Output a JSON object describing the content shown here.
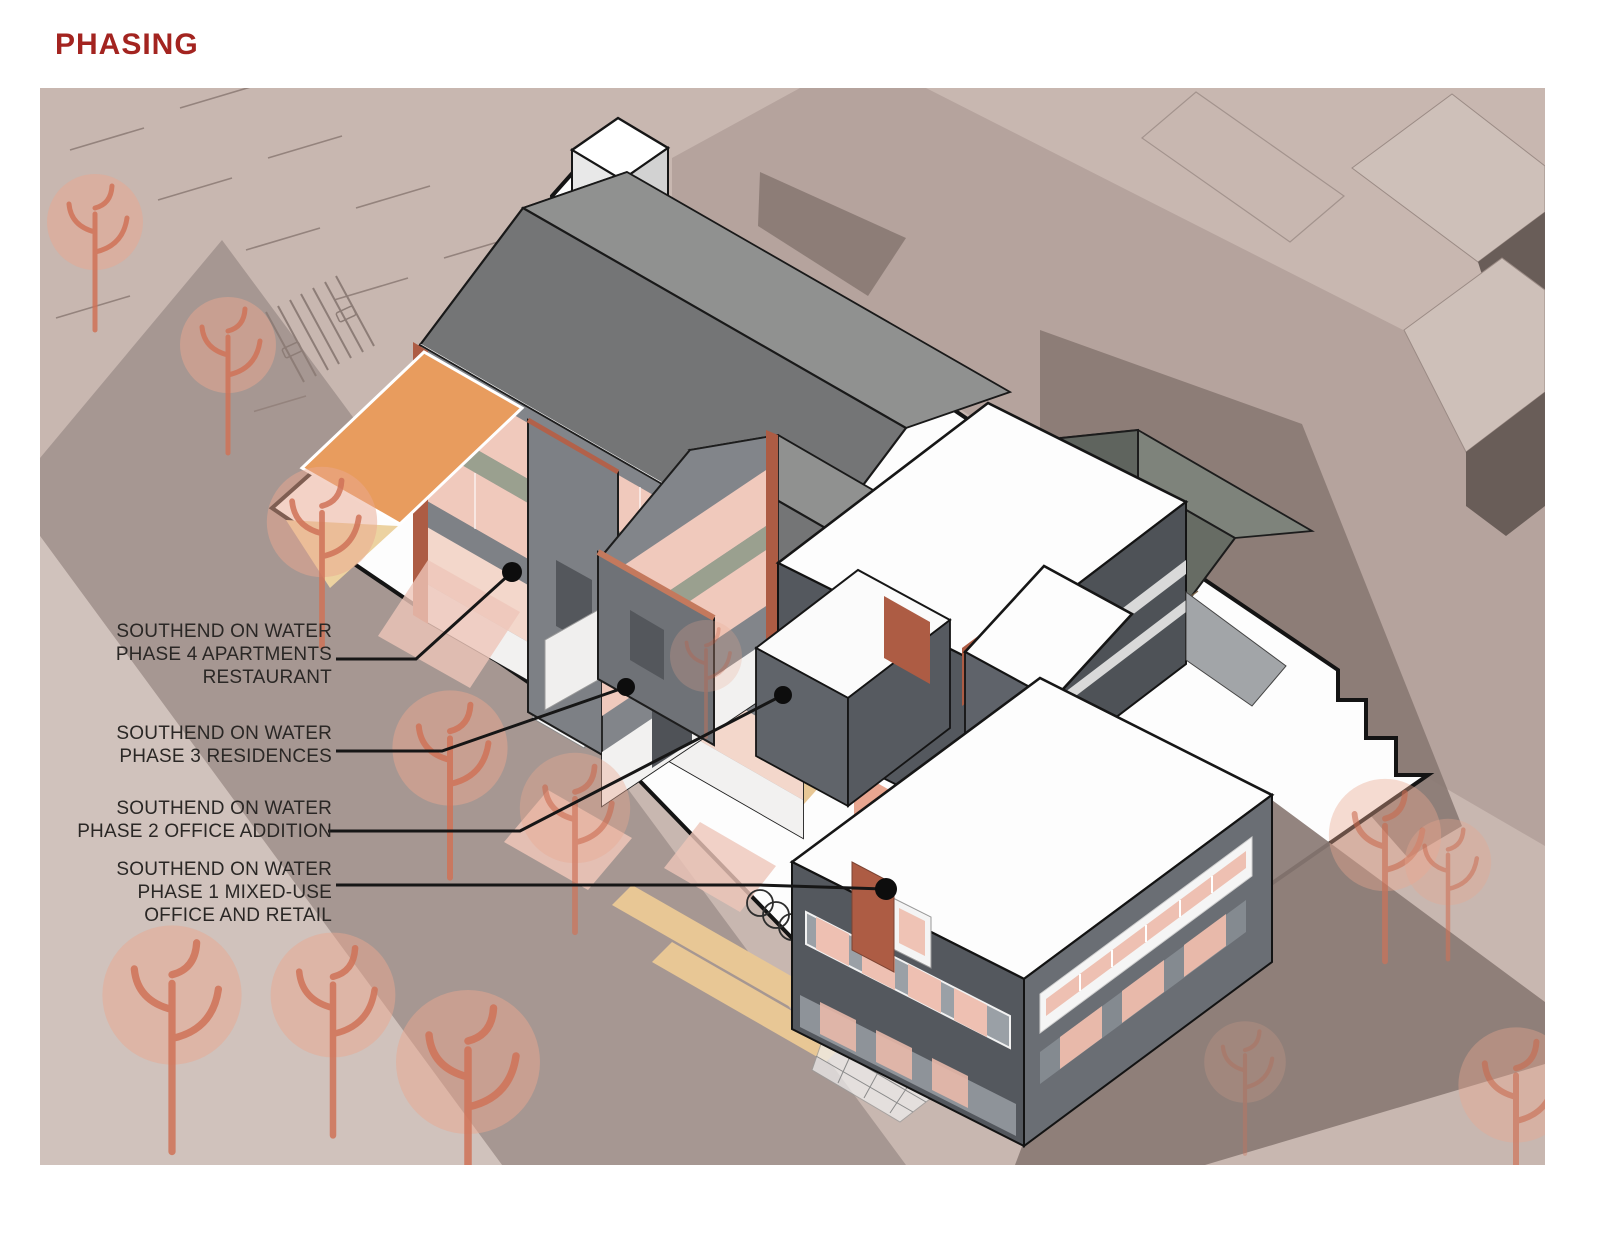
{
  "title": "PHASING",
  "labels": [
    {
      "id": "phase-4",
      "lines": [
        "SOUTHEND ON WATER",
        "PHASE 4 APARTMENTS",
        "RESTAURANT"
      ]
    },
    {
      "id": "phase-3",
      "lines": [
        "SOUTHEND ON WATER",
        "PHASE 3 RESIDENCES"
      ]
    },
    {
      "id": "phase-2",
      "lines": [
        "SOUTHEND ON WATER",
        "PHASE 2 OFFICE ADDITION"
      ]
    },
    {
      "id": "phase-1",
      "lines": [
        "SOUTHEND ON WATER",
        "PHASE 1 MIXED-USE",
        "OFFICE AND RETAIL"
      ]
    }
  ],
  "palette": {
    "title-red": "#a32420",
    "ground": "#c8b7b0",
    "street": "#a69792",
    "sidewalk": "#d0c2bc",
    "far-street": "#b5a39d",
    "shadow": "#8a7a74",
    "context-top": "#cec0b9",
    "context-face": "#695d58",
    "site-white": "#fdfdfd",
    "roof-gray": "#747576",
    "roof-light": "#909190",
    "wall-gray": "#82858a",
    "wall-dark": "#54585e",
    "olive": "#9aa08f",
    "salmon": "#f0c9bc",
    "terracotta": "#ad5c44",
    "orange-deck": "#e89c5e",
    "tan-planter": "#e8c795",
    "tree": "#e9a78f",
    "tree-trunk": "#cf7257"
  }
}
